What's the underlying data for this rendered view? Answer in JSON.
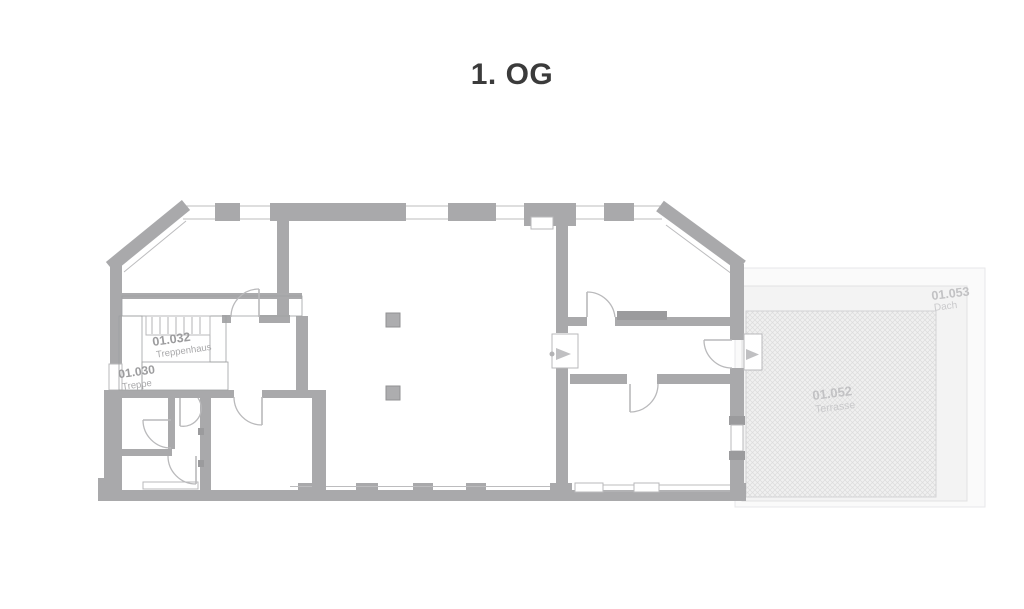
{
  "title": "1. OG",
  "plan_type": "floor-plan",
  "rooms": [
    {
      "id": "01.030",
      "name": "Treppe"
    },
    {
      "id": "01.032",
      "name": "Treppenhaus"
    },
    {
      "id": "01.052",
      "name": "Terrasse"
    },
    {
      "id": "01.053",
      "name": "Dach"
    }
  ],
  "colors": {
    "wall": "#a9a9ab",
    "stair_fill": "#c7c7c9",
    "terrace_hatch_line": "#dcdcdc",
    "terrace_base": "#f0f0f0",
    "roof_area": "#f3f3f3",
    "label_dark": "#9c9c9e",
    "label_light": "#c2c2c4",
    "title_text": "#3b3b3b"
  }
}
